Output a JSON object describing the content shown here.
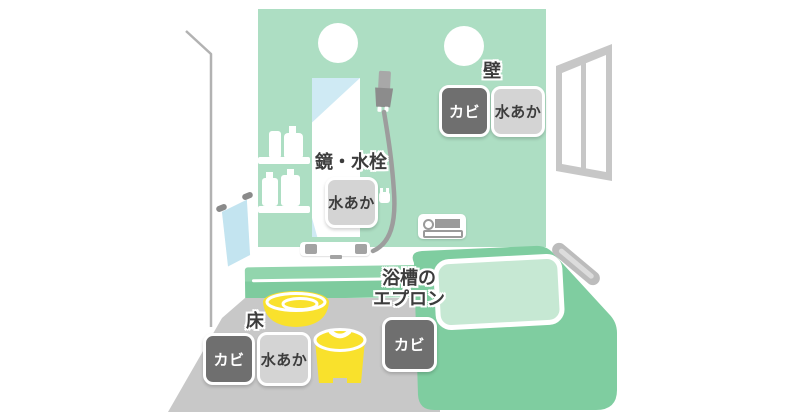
{
  "figure": {
    "type": "bathroom-cleaning-spots-illustration",
    "spots": {
      "wall": {
        "label": "壁",
        "badges": [
          {
            "kind": "mold",
            "text": "カビ"
          },
          {
            "kind": "water-scale",
            "text": "水あか"
          }
        ]
      },
      "mirror_faucet": {
        "label": "鏡・水栓",
        "badges": [
          {
            "kind": "water-scale",
            "text": "水あか"
          }
        ]
      },
      "floor": {
        "label": "床",
        "badges": [
          {
            "kind": "mold",
            "text": "カビ"
          },
          {
            "kind": "water-scale",
            "text": "水あか"
          }
        ]
      },
      "bathtub_apron": {
        "label_line1": "浴槽の",
        "label_line2": "エプロン",
        "badges": [
          {
            "kind": "mold",
            "text": "カビ"
          }
        ]
      }
    },
    "colors": {
      "wall_green": "#addec3",
      "fixture_green": "#7fcda0",
      "bath_water_green": "#c6e8d3",
      "floor_gray": "#c8c8c8",
      "mold_badge_gray": "#6f6f6f",
      "scale_badge_gray": "#d4d4d4",
      "label_text": "#3c3c3c",
      "mirror_blue": "#cfeaf4",
      "towel_blue": "#c3e4f0",
      "bath_goods_yellow": "#f9e12c"
    }
  }
}
